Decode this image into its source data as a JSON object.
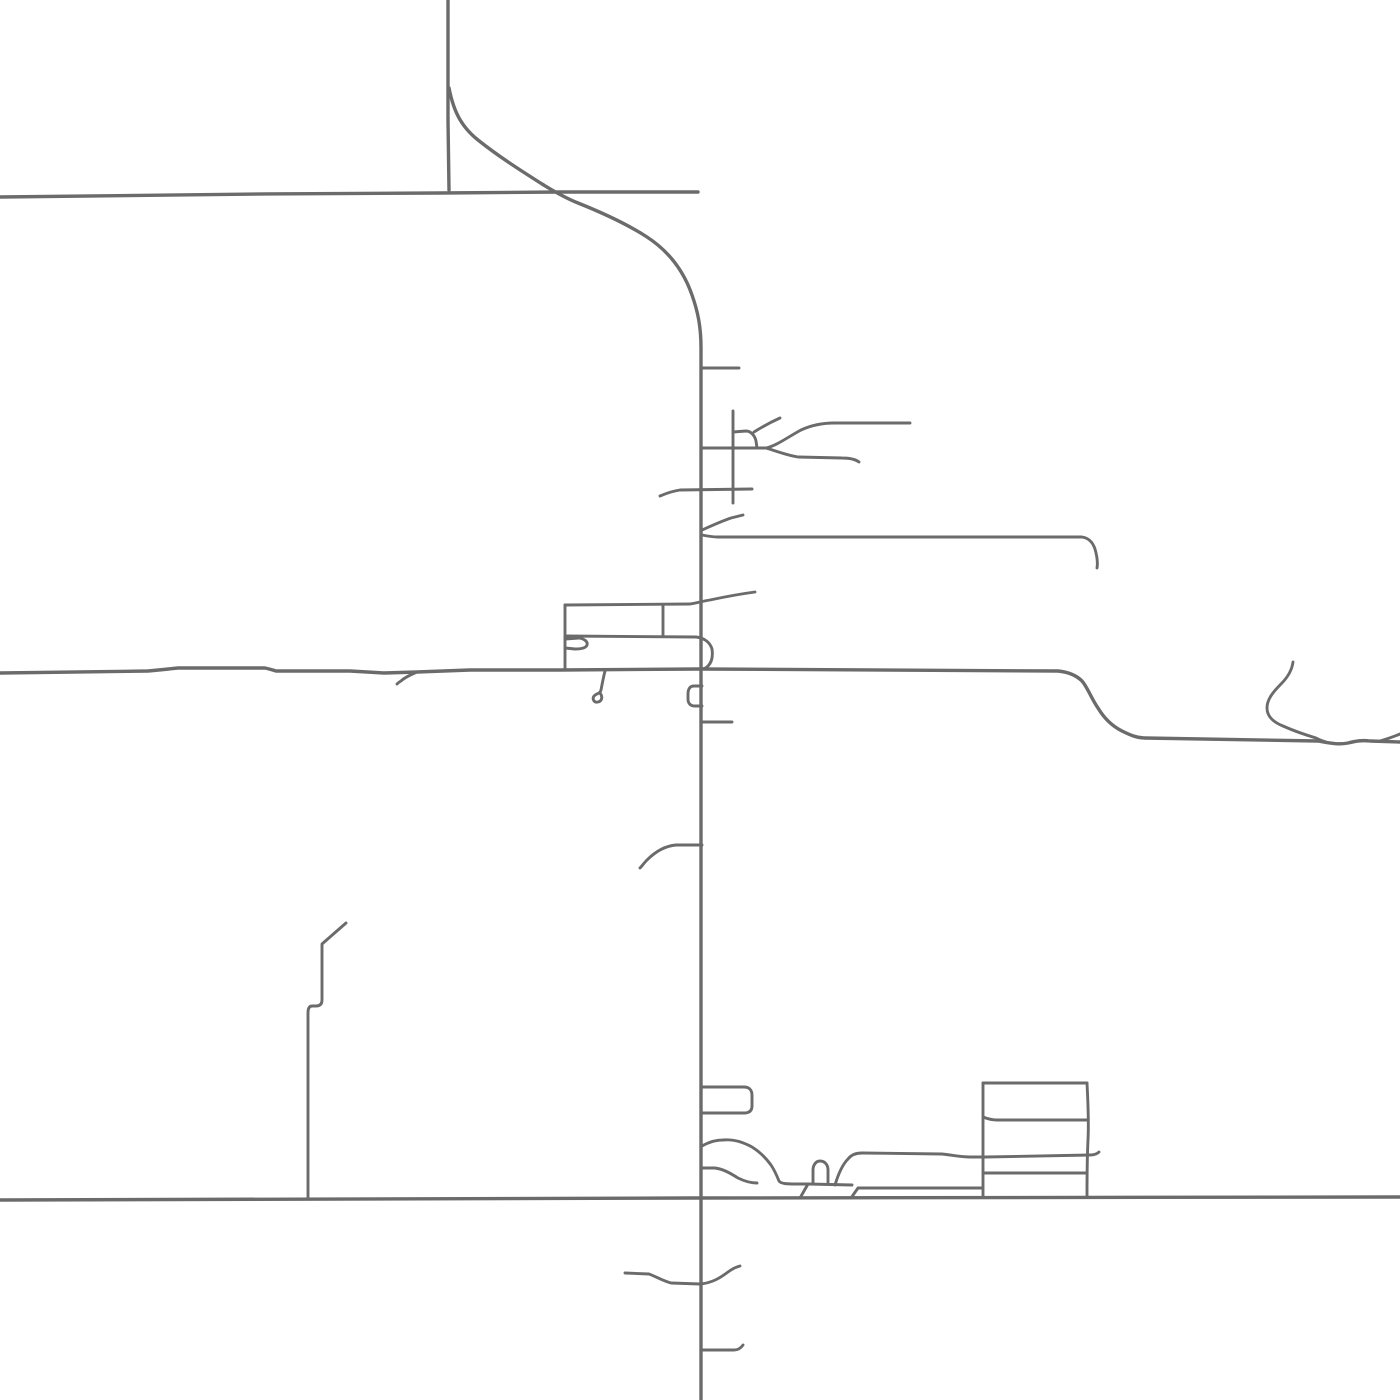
{
  "map": {
    "viewBox": "0 0 1400 1400",
    "background": "#ffffff",
    "road_color": "#6b6b6b",
    "stroke_widths": {
      "major": 3.4,
      "minor": 2.9
    },
    "roads": [
      {
        "name": "road-top-horizontal",
        "class": "major",
        "d": "M0,197 C80,196 300,193 440,193 L560,192 L698,192"
      },
      {
        "name": "road-north-vertical",
        "class": "major",
        "d": "M448,0 L448,120 L449,190"
      },
      {
        "name": "road-curve-and-main-vertical",
        "class": "major",
        "d": "M449,88 C454,114 463,128 478,140 C498,156 520,170 542,184 C552,190 563,197 578,203 C603,213 627,224 647,237 C670,252 684,272 692,295 C698,312 701,327 701,348 L701,1400"
      },
      {
        "name": "road-mid-horizontal",
        "class": "major",
        "d": "M0,673 L148,671 C160,670 168,669 178,668 L265,668 C270,669 272,670 276,671 L350,671 L384,673 L417,672 L470,670 L560,670 L700,669 L1058,671 C1068,672 1076,675 1082,681 C1088,688 1091,698 1098,708 C1104,718 1112,726 1122,731 C1130,735 1137,738 1145,738 L1318,741 C1330,743 1338,745 1348,743 C1356,741 1362,740 1370,741 L1400,742"
      },
      {
        "name": "road-bottom-horizontal",
        "class": "major",
        "d": "M0,1200 L690,1198 L1400,1197"
      },
      {
        "name": "spur-mid-road-west",
        "class": "minor",
        "d": "M417,672 C410,675 404,678 401,681 C399,682 398,683 397,684"
      },
      {
        "name": "stub-north-east",
        "class": "minor",
        "d": "M702,368 L739,368"
      },
      {
        "name": "street-grid-horizontal",
        "class": "minor",
        "d": "M702,448 L766,448"
      },
      {
        "name": "street-grid-branch-upper",
        "class": "minor",
        "d": "M766,448 C776,446 788,437 801,430 C812,425 822,423 834,423 L910,423"
      },
      {
        "name": "street-grid-branch-lower",
        "class": "minor",
        "d": "M766,448 C776,451 786,455 798,457 L842,458 C850,458 855,459 859,462"
      },
      {
        "name": "street-grid-diagonal",
        "class": "minor",
        "d": "M754,432 C762,427 771,422 780,418"
      },
      {
        "name": "street-grid-connector",
        "class": "minor",
        "d": "M733,432 L746,431 C751,431 755,436 756,441 L757,448"
      },
      {
        "name": "street-grid-vertical",
        "class": "minor",
        "d": "M733,411 L733,503"
      },
      {
        "name": "street-490-west",
        "class": "minor",
        "d": "M660,496 C667,493 673,491 680,490 L752,489"
      },
      {
        "name": "road-537-east",
        "class": "minor",
        "d": "M702,535 C707,536 712,537 718,537 L1082,537 C1089,538 1093,543 1095,549 C1097,556 1098,562 1097,568"
      },
      {
        "name": "spur-537-diagonal",
        "class": "minor",
        "d": "M702,530 C711,526 722,521 731,518 C735,517 739,516 743,515"
      },
      {
        "name": "street-rect-top",
        "class": "minor",
        "d": "M565,605 L690,604 C697,603 703,601 710,600 C724,597 740,594 755,592"
      },
      {
        "name": "street-rect-divider",
        "class": "minor",
        "d": "M663,605 L663,636"
      },
      {
        "name": "street-rect-mid-p-loop",
        "class": "minor",
        "d": "M565,636 L696,637 C704,638 710,642 712,649 C713,656 712,662 708,666 C706,668 704,669 702,669"
      },
      {
        "name": "street-rect-left-vertical",
        "class": "minor",
        "d": "M565,605 L565,670"
      },
      {
        "name": "loop-hook-west",
        "class": "minor",
        "d": "M565,639 L579,638 C585,639 588,642 587,645 C586,648 581,649 575,649 L565,648"
      },
      {
        "name": "spur-culdesac-600",
        "class": "minor",
        "d": "M605,671 C603,679 602,685 601,690 C600,694 597,693 594,696 C592,699 594,703 598,702 C602,701 603,697 600,693"
      },
      {
        "name": "loop-c-shape",
        "class": "minor",
        "d": "M702,686 L694,686 C690,686 688,689 688,694 L688,699 C688,704 691,706 695,706 L702,706"
      },
      {
        "name": "stub-722-east",
        "class": "minor",
        "d": "M702,722 L732,722"
      },
      {
        "name": "arc-845-west",
        "class": "minor",
        "d": "M702,845 L676,845 C664,846 655,852 647,860 C644,863 642,866 640,868"
      },
      {
        "name": "squiggle-branch-northeast",
        "class": "minor",
        "d": "M1293,662 C1292,670 1288,677 1281,684 C1272,693 1267,700 1267,708 C1267,716 1273,722 1283,726 C1294,731 1306,735 1316,738 C1320,740 1323,741 1326,742"
      },
      {
        "name": "fork-right-edge",
        "class": "minor",
        "d": "M1380,741 C1387,739 1393,737 1400,734"
      },
      {
        "name": "street-left-vertical",
        "class": "minor",
        "d": "M346,923 C338,930 330,937 322,944 L322,1000 C322,1004 320,1006 316,1006 L312,1006 C309,1006 308,1009 308,1013 L308,1198"
      },
      {
        "name": "block-rounded-rect",
        "class": "minor",
        "d": "M702,1087 L744,1087 C749,1087 752,1090 752,1095 L752,1106 C752,1111 749,1113 744,1113 L702,1113"
      },
      {
        "name": "blob-upper-edge",
        "class": "minor",
        "d": "M702,1146 C709,1142 716,1140 723,1140 C733,1139 743,1142 752,1147 C760,1152 766,1158 771,1165 C775,1171 777,1176 779,1181 C781,1184 788,1184 796,1184 L808,1184 L852,1185"
      },
      {
        "name": "blob-lower-edge",
        "class": "minor",
        "d": "M702,1168 L715,1168 C723,1169 730,1173 738,1178 C744,1181 750,1183 757,1183"
      },
      {
        "name": "leg-road-to-1184",
        "class": "minor",
        "d": "M800,1198 L808,1184"
      },
      {
        "name": "loop-n-shape",
        "class": "minor",
        "d": "M813,1183 L813,1170 C813,1165 816,1161 820,1161 C825,1161 828,1165 828,1170 L828,1182"
      },
      {
        "name": "street-1155-east",
        "class": "minor",
        "d": "M835,1185 C838,1175 842,1165 848,1159 C851,1155 856,1153 862,1153 L942,1154 C952,1155 960,1157 970,1157 L985,1157 L1090,1155 C1094,1155 1097,1154 1099,1152"
      },
      {
        "name": "leg-road-to-1188",
        "class": "minor",
        "d": "M851,1198 L858,1188 L983,1188"
      },
      {
        "name": "ladder-left-vertical",
        "class": "minor",
        "d": "M983,1083 L983,1197"
      },
      {
        "name": "ladder-right-vertical",
        "class": "minor",
        "d": "M1087,1083 C1088,1103 1089,1120 1088,1140 C1087,1160 1087,1180 1087,1196"
      },
      {
        "name": "ladder-top-horizontal",
        "class": "minor",
        "d": "M983,1083 L1087,1083"
      },
      {
        "name": "ladder-second-horizontal",
        "class": "minor",
        "d": "M983,1117 C988,1119 992,1120 997,1120 L1087,1120"
      },
      {
        "name": "ladder-third-horizontal",
        "class": "minor",
        "d": "M983,1173 L1087,1173"
      },
      {
        "name": "squiggle-south",
        "class": "minor",
        "d": "M625,1273 L649,1274 C657,1277 663,1281 671,1283 L700,1284 C712,1283 720,1278 728,1272 C732,1269 736,1267 740,1266"
      },
      {
        "name": "stub-south-east",
        "class": "minor",
        "d": "M702,1350 L734,1350 C738,1350 741,1348 743,1345"
      }
    ]
  }
}
